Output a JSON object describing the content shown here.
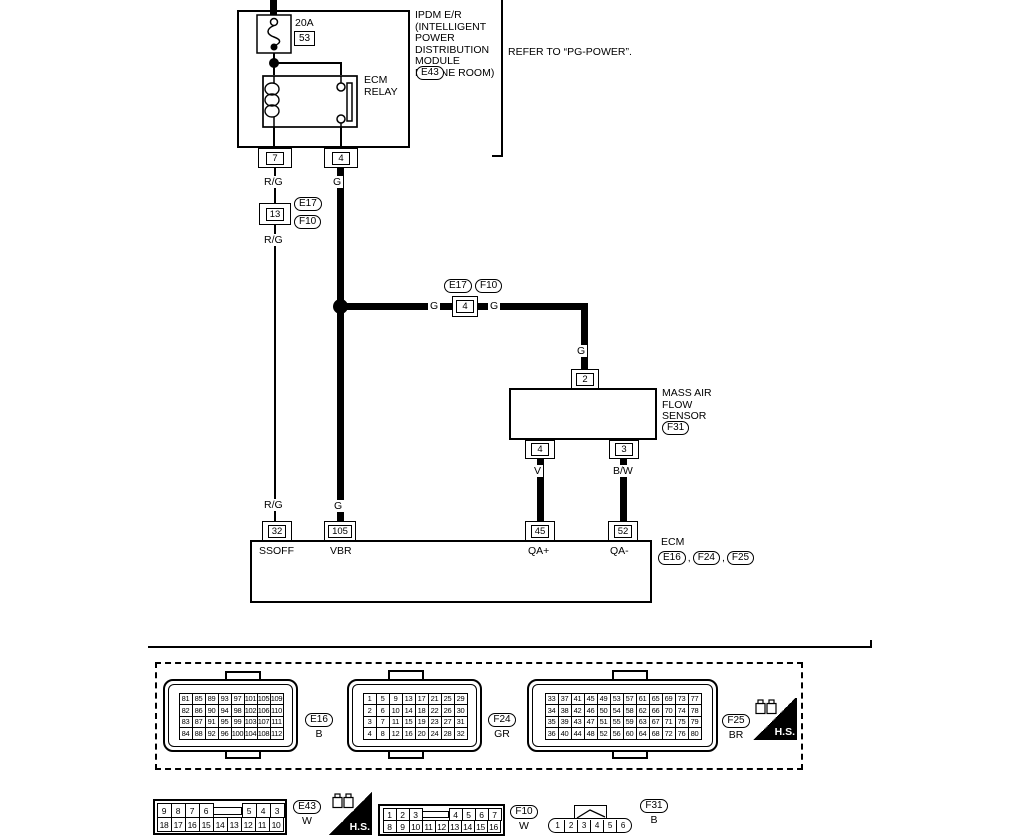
{
  "ipdm": {
    "title_lines": [
      "IPDM E/R",
      "(INTELLIGENT",
      "POWER",
      "DISTRIBUTION",
      "MODULE",
      "ENGINE ROOM)"
    ],
    "connector_id": "E43",
    "fuse": {
      "rating": "20A",
      "number": "53"
    },
    "relay": {
      "line1": "ECM",
      "line2": "RELAY"
    },
    "pin_left": "7",
    "pin_right": "4",
    "refer_note": "REFER TO “PG-POWER”."
  },
  "left_branch": {
    "pin": "13",
    "connector_ids": [
      "E17",
      "F10"
    ]
  },
  "splice": {
    "pin": "4",
    "connector_ids": [
      "E17",
      "F10"
    ]
  },
  "maf": {
    "title_lines": [
      "MASS AIR",
      "FLOW",
      "SENSOR"
    ],
    "connector_id": "F31",
    "pin_top": "2",
    "pin_left": "4",
    "pin_right": "3"
  },
  "ecm": {
    "title": "ECM",
    "separator": ",",
    "connector_ids": [
      "E16",
      "F24",
      "F25"
    ],
    "pins": [
      {
        "num": "32",
        "name": "SSOFF"
      },
      {
        "num": "105",
        "name": "VBR"
      },
      {
        "num": "45",
        "name": "QA+"
      },
      {
        "num": "52",
        "name": "QA-"
      }
    ]
  },
  "wire_labels": {
    "rg": "R/G",
    "g": "G",
    "v": "V",
    "bw": "B/W"
  },
  "connector_views": {
    "hs_label": "H.S.",
    "e16": {
      "id": "E16",
      "color_code": "B",
      "rows": [
        [
          "81",
          "85",
          "89",
          "93",
          "97",
          "101",
          "105",
          "109"
        ],
        [
          "82",
          "86",
          "90",
          "94",
          "98",
          "102",
          "106",
          "110"
        ],
        [
          "83",
          "87",
          "91",
          "95",
          "99",
          "103",
          "107",
          "111"
        ],
        [
          "84",
          "88",
          "92",
          "96",
          "100",
          "104",
          "108",
          "112"
        ]
      ]
    },
    "f24": {
      "id": "F24",
      "color_code": "GR",
      "rows": [
        [
          "1",
          "5",
          "9",
          "13",
          "17",
          "21",
          "25",
          "29"
        ],
        [
          "2",
          "6",
          "10",
          "14",
          "18",
          "22",
          "26",
          "30"
        ],
        [
          "3",
          "7",
          "11",
          "15",
          "19",
          "23",
          "27",
          "31"
        ],
        [
          "4",
          "8",
          "12",
          "16",
          "20",
          "24",
          "28",
          "32"
        ]
      ]
    },
    "f25": {
      "id": "F25",
      "color_code": "BR",
      "rows": [
        [
          "33",
          "37",
          "41",
          "45",
          "49",
          "53",
          "57",
          "61",
          "65",
          "69",
          "73",
          "77"
        ],
        [
          "34",
          "38",
          "42",
          "46",
          "50",
          "54",
          "58",
          "62",
          "66",
          "70",
          "74",
          "78"
        ],
        [
          "35",
          "39",
          "43",
          "47",
          "51",
          "55",
          "59",
          "63",
          "67",
          "71",
          "75",
          "79"
        ],
        [
          "36",
          "40",
          "44",
          "48",
          "52",
          "56",
          "60",
          "64",
          "68",
          "72",
          "76",
          "80"
        ]
      ]
    },
    "e43": {
      "id": "E43",
      "color_code": "W",
      "rows": [
        [
          "9",
          "8",
          "7",
          "6",
          "",
          "5",
          "4",
          "3"
        ],
        [
          "18",
          "17",
          "16",
          "15",
          "14",
          "13",
          "12",
          "11",
          "10"
        ]
      ]
    },
    "f10": {
      "id": "F10",
      "color_code": "W",
      "rows": [
        [
          "1",
          "2",
          "3",
          "",
          "4",
          "5",
          "6",
          "7"
        ],
        [
          "8",
          "9",
          "10",
          "11",
          "12",
          "13",
          "14",
          "15",
          "16"
        ]
      ]
    },
    "f31": {
      "id": "F31",
      "color_code": "B",
      "rows": [
        [
          "1",
          "2",
          "3",
          "4",
          "5",
          "6"
        ]
      ]
    }
  }
}
